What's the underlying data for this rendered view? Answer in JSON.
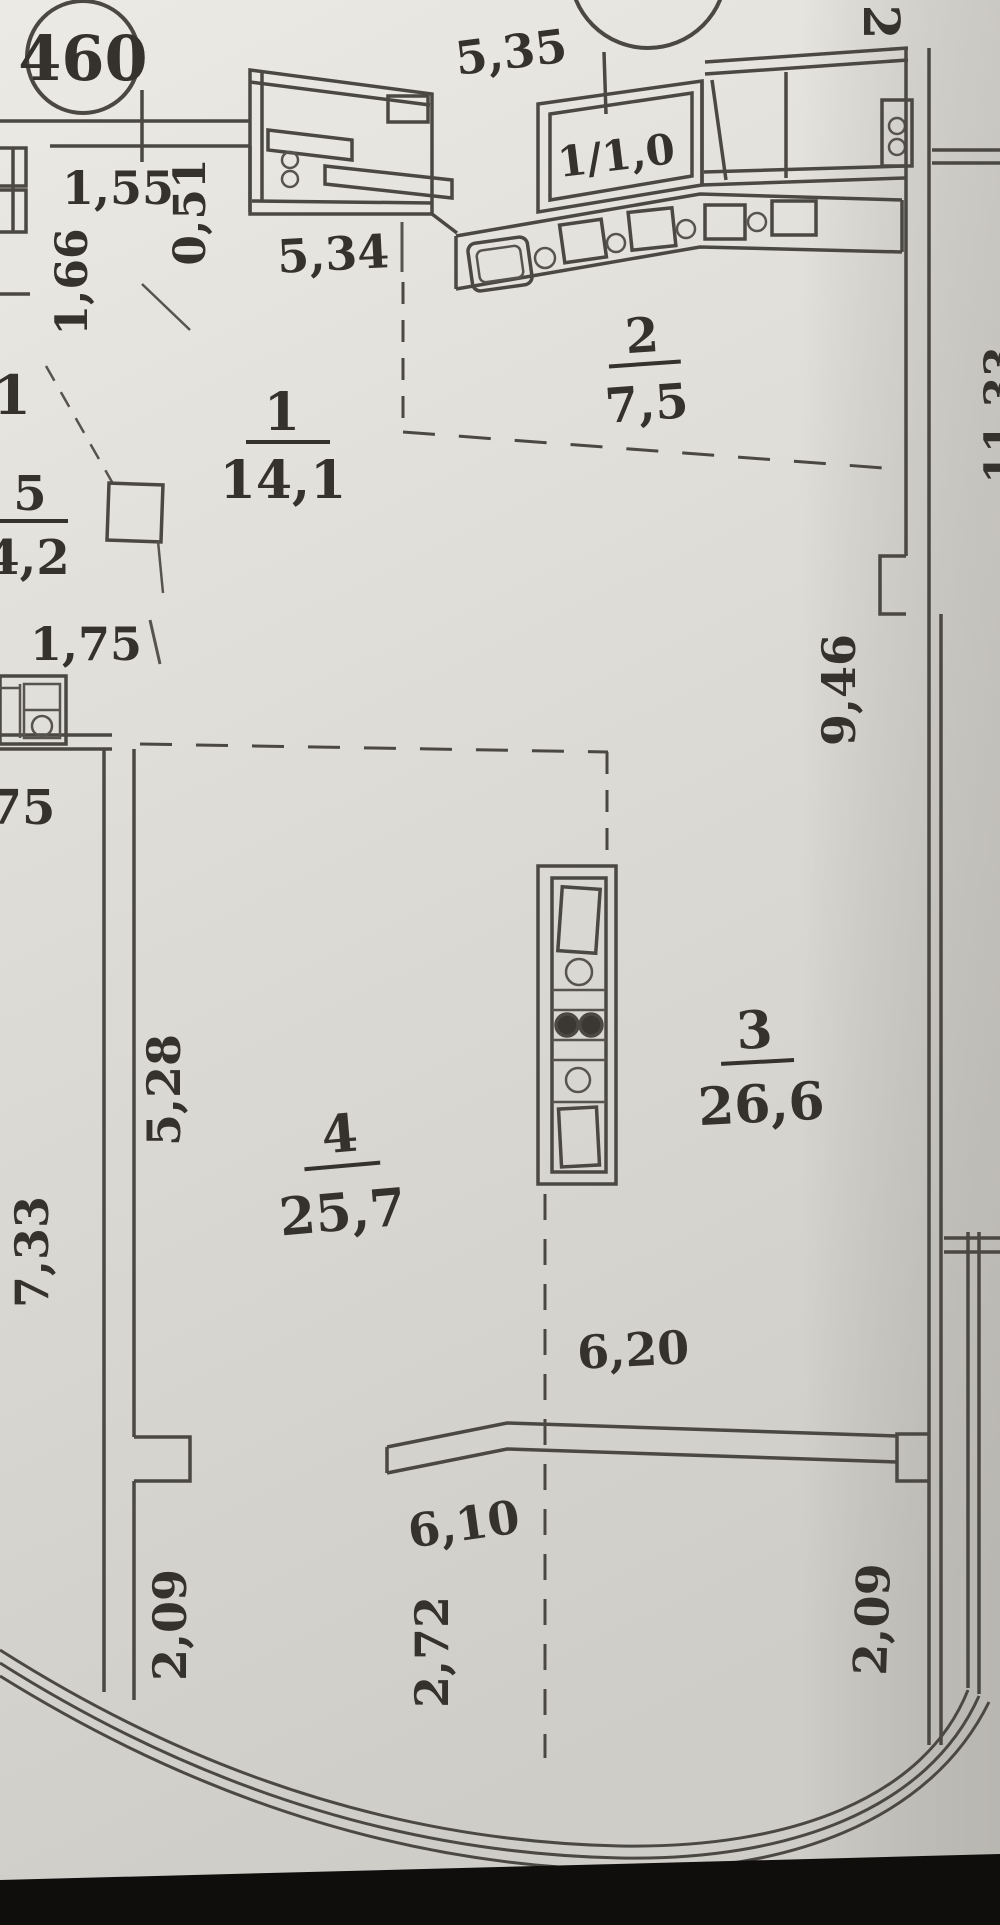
{
  "plan_title": "apartment floor plan",
  "badges": {
    "apartment_number": "460",
    "apartment_number_2": "115"
  },
  "rooms": [
    {
      "number": "1",
      "area": "14,1"
    },
    {
      "number": "2",
      "area": "7,5"
    },
    {
      "number": "3",
      "area": "26,6"
    },
    {
      "number": "4",
      "area": "25,7"
    },
    {
      "number": "5",
      "area": "4,2"
    }
  ],
  "balcony_label": "1/1,0",
  "dims": {
    "d5_35": "5,35",
    "d5_34": "5,34",
    "d1_55": "1,55",
    "d0_51": "0,51",
    "d1_66": "1,66",
    "d1_75": "1,75",
    "d9_46": "9,46",
    "d11_33": "11,33",
    "d5_28": "5,28",
    "d7_33": "7,33",
    "d6_20": "6,20",
    "d6_10": "6,10",
    "d2_72": "2,72",
    "d2_09_left": "2,09",
    "d2_09_right": "2,09"
  },
  "neighbor_labels": {
    "cut_1": "1",
    "cut_75": "75",
    "cut_2": "2"
  },
  "colors": {
    "paper_light": "#e9e7e1",
    "paper_dark": "#d2d0cb",
    "ink": "#35322d",
    "wall": "#4b4844",
    "photo_edge": "#0f0e0c"
  }
}
